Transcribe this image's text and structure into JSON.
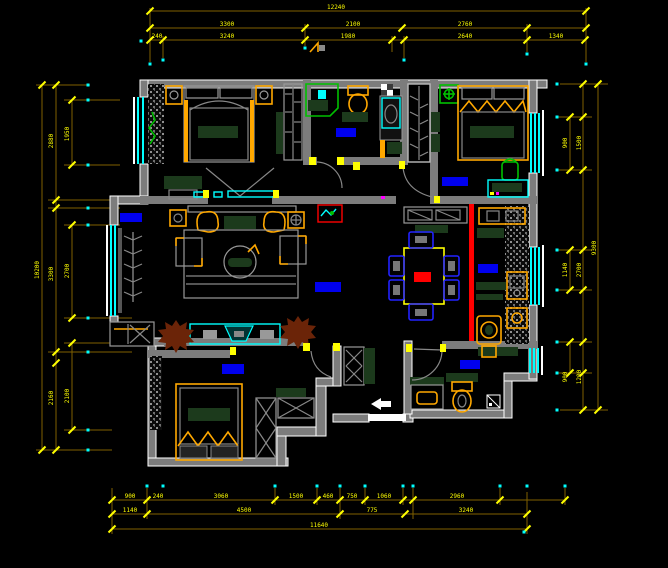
{
  "viewport": {
    "kind": "cad-floor-plan",
    "width": 668,
    "height": 568
  },
  "colors": {
    "background": "#000000",
    "wall": "#7c7c7c",
    "exterior_outline": "#ffffff",
    "dimension_line": "#7f6000",
    "dimension_text": "#ffff00",
    "window_glass": "#00ffff",
    "room_label_marker": "#0000ee",
    "furniture_accent": "#ffa800",
    "cabinet_fill": "#1c3a1c",
    "fixture_green": "#00c000",
    "feature_wall": "#ff0000",
    "plant": "#6b2408"
  },
  "dimensions": {
    "top": {
      "total": [
        "12240"
      ],
      "middle": [
        "3300",
        "2100",
        "2760"
      ],
      "inner": [
        "240",
        "3240",
        "1980",
        "2640",
        "1340"
      ]
    },
    "bottom": {
      "inner": [
        "900",
        "240",
        "3060",
        "1500",
        "460",
        "750",
        "1060",
        "2960"
      ],
      "middle": [
        "1140",
        "4500",
        "775",
        "3240"
      ],
      "total": [
        "11640"
      ]
    },
    "left": {
      "inner": [
        "1950",
        "2700",
        "2100"
      ],
      "middle": [
        "2880",
        "3300",
        "2160"
      ],
      "total": [
        "10200"
      ]
    },
    "right": {
      "inner": [
        "900",
        "1140",
        "900"
      ],
      "middle": [
        "1500",
        "2700",
        "1200"
      ],
      "total": [
        "9300"
      ]
    }
  }
}
